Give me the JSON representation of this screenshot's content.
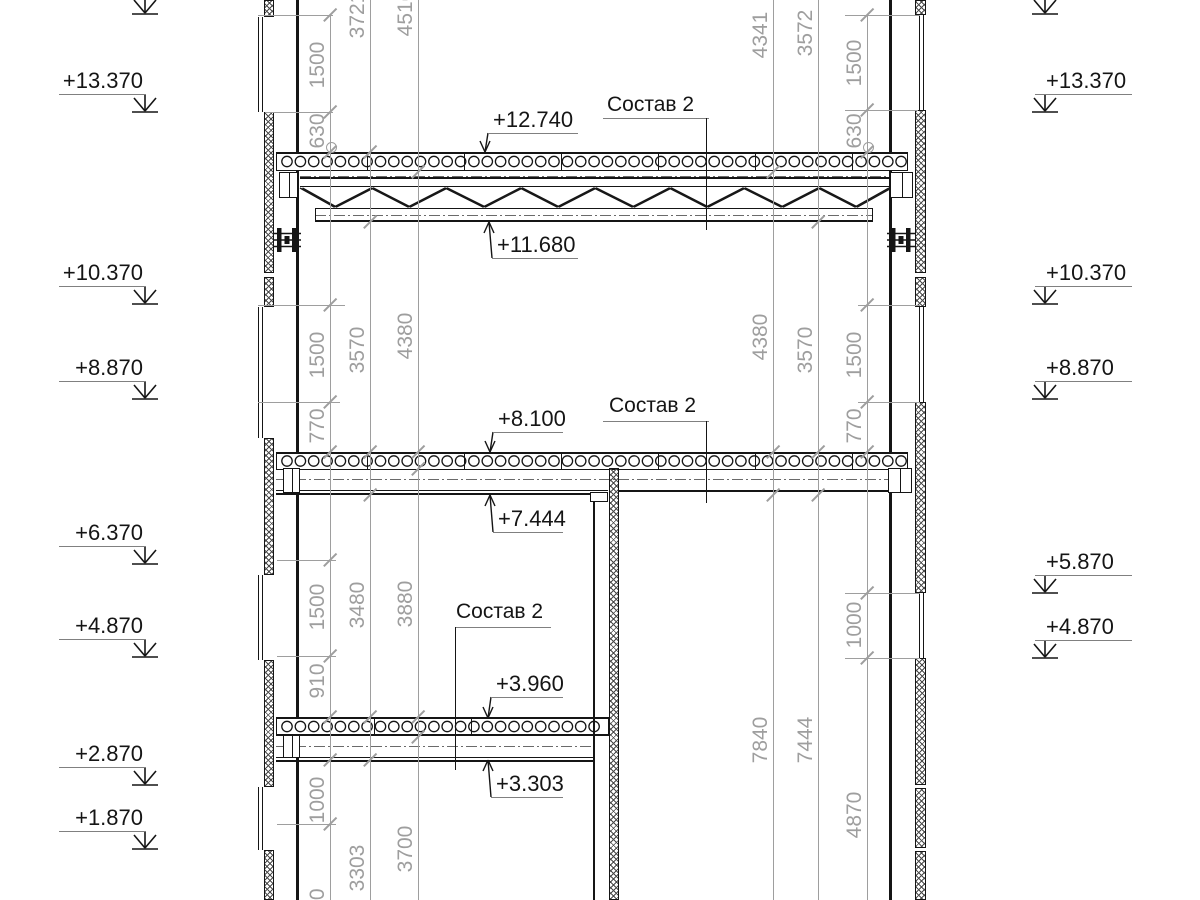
{
  "drawing": {
    "colors": {
      "line": "#151515",
      "dim": "#9e9e9e",
      "underline": "#808080",
      "background": "#ffffff"
    },
    "elevation_marks": {
      "left": [
        {
          "label": null,
          "uy": -4
        },
        {
          "label": "+13.370",
          "uy": 94
        },
        {
          "label": "+10.370",
          "uy": 286
        },
        {
          "label": "+8.870",
          "uy": 381
        },
        {
          "label": "+6.370",
          "uy": 546
        },
        {
          "label": "+4.870",
          "uy": 639
        },
        {
          "label": "+2.870",
          "uy": 767
        },
        {
          "label": "+1.870",
          "uy": 831
        }
      ],
      "right": [
        {
          "label": null,
          "uy": -4
        },
        {
          "label": "+13.370",
          "uy": 94
        },
        {
          "label": "+10.370",
          "uy": 286
        },
        {
          "label": "+8.870",
          "uy": 381
        },
        {
          "label": "+5.870",
          "uy": 575
        },
        {
          "label": "+4.870",
          "uy": 640
        }
      ]
    },
    "spot_elevations": [
      {
        "label": "+12.740",
        "x": 488,
        "uy": 133,
        "w": 90,
        "tip": 152,
        "dir": "down"
      },
      {
        "label": "+11.680",
        "x": 492,
        "uy": 258,
        "w": 86,
        "tip": 222,
        "dir": "up"
      },
      {
        "label": "+8.100",
        "x": 493,
        "uy": 432,
        "w": 70,
        "tip": 452,
        "dir": "down"
      },
      {
        "label": "+7.444",
        "x": 493,
        "uy": 532,
        "w": 70,
        "tip": 495,
        "dir": "up"
      },
      {
        "label": "+3.960",
        "x": 491,
        "uy": 697,
        "w": 72,
        "tip": 718,
        "dir": "down"
      },
      {
        "label": "+3.303",
        "x": 491,
        "uy": 797,
        "w": 72,
        "tip": 760,
        "dir": "up"
      }
    ],
    "composition_labels": [
      {
        "text": "Состав 2",
        "tx": 607,
        "ty": 94,
        "ux1": 603,
        "ux2": 709,
        "uy": 118,
        "lx": 706,
        "ly1": 118,
        "ly2": 230
      },
      {
        "text": "Состав 2",
        "tx": 609,
        "ty": 395,
        "ux1": 603,
        "ux2": 709,
        "uy": 421,
        "lx": 706,
        "ly1": 421,
        "ly2": 503
      },
      {
        "text": "Состав 2",
        "tx": 456,
        "ty": 601,
        "ux1": 455,
        "ux2": 551,
        "uy": 627,
        "lx": 455,
        "ly1": 627,
        "ly2": 770
      }
    ],
    "dimension_chains": {
      "left": [
        {
          "x": 330,
          "y1": 15,
          "y2": 900,
          "items": [
            {
              "t": "1500",
              "cy": 65
            },
            {
              "t": "630",
              "cy": 131
            },
            {
              "t": "1500",
              "cy": 355
            },
            {
              "t": "770",
              "cy": 426
            },
            {
              "t": "1500",
              "cy": 607
            },
            {
              "t": "910",
              "cy": 681
            },
            {
              "t": "1000",
              "cy": 800
            },
            {
              "t": "970",
              "cy": 906
            }
          ]
        },
        {
          "x": 370,
          "y1": 0,
          "y2": 900,
          "items": [
            {
              "t": "3721",
              "cy": 15
            },
            {
              "t": "3570",
              "cy": 350
            },
            {
              "t": "3480",
              "cy": 605
            },
            {
              "t": "3303",
              "cy": 868
            }
          ]
        },
        {
          "x": 418,
          "y1": 0,
          "y2": 900,
          "items": [
            {
              "t": "4516",
              "cy": 13
            },
            {
              "t": "4380",
              "cy": 336
            },
            {
              "t": "3880",
              "cy": 604
            },
            {
              "t": "3700",
              "cy": 849
            }
          ]
        }
      ],
      "right": [
        {
          "x": 867,
          "y1": 15,
          "y2": 900,
          "items": [
            {
              "t": "1500",
              "cy": 63
            },
            {
              "t": "630",
              "cy": 131
            },
            {
              "t": "1500",
              "cy": 355
            },
            {
              "t": "770",
              "cy": 426
            },
            {
              "t": "1000",
              "cy": 625
            },
            {
              "t": "4870",
              "cy": 815
            }
          ]
        },
        {
          "x": 818,
          "y1": 0,
          "y2": 900,
          "items": [
            {
              "t": "3572",
              "cy": 33
            },
            {
              "t": "3570",
              "cy": 350
            },
            {
              "t": "7444",
              "cy": 740
            }
          ]
        },
        {
          "x": 773,
          "y1": 0,
          "y2": 900,
          "items": [
            {
              "t": "4341",
              "cy": 35
            },
            {
              "t": "4380",
              "cy": 337
            },
            {
              "t": "7840",
              "cy": 740
            }
          ]
        }
      ]
    },
    "extension_lines": [
      [
        258,
        333,
        15
      ],
      [
        265,
        333,
        112
      ],
      [
        258,
        345,
        305
      ],
      [
        258,
        340,
        402
      ],
      [
        277,
        336,
        560
      ],
      [
        277,
        336,
        656
      ],
      [
        277,
        336,
        824
      ],
      [
        845,
        920,
        15
      ],
      [
        845,
        918,
        110
      ],
      [
        858,
        920,
        305
      ],
      [
        858,
        920,
        402
      ],
      [
        845,
        920,
        593
      ],
      [
        845,
        920,
        658
      ]
    ],
    "ticks": [
      [
        330,
        15
      ],
      [
        330,
        112
      ],
      [
        330,
        152
      ],
      [
        330,
        305
      ],
      [
        330,
        402
      ],
      [
        330,
        452
      ],
      [
        330,
        560
      ],
      [
        330,
        656
      ],
      [
        330,
        717
      ],
      [
        330,
        760
      ],
      [
        330,
        824
      ],
      [
        370,
        152
      ],
      [
        370,
        222
      ],
      [
        370,
        452
      ],
      [
        370,
        495
      ],
      [
        370,
        717
      ],
      [
        370,
        760
      ],
      [
        418,
        172
      ],
      [
        418,
        452
      ],
      [
        418,
        469
      ],
      [
        418,
        717
      ],
      [
        418,
        737
      ],
      [
        867,
        15
      ],
      [
        867,
        110
      ],
      [
        867,
        152
      ],
      [
        867,
        305
      ],
      [
        867,
        402
      ],
      [
        867,
        452
      ],
      [
        867,
        593
      ],
      [
        867,
        658
      ],
      [
        818,
        222
      ],
      [
        818,
        452
      ],
      [
        818,
        495
      ],
      [
        773,
        172
      ],
      [
        773,
        452
      ],
      [
        773,
        495
      ]
    ],
    "dim_circles": [
      [
        330,
        146
      ],
      [
        867,
        146
      ]
    ],
    "slabs": [
      {
        "x1": 276,
        "x2": 908,
        "top": 152,
        "cy": 161.5,
        "cx1": 282,
        "cx2": 904,
        "bottom": 169.5,
        "joints": [
          367,
          464,
          561,
          658,
          755,
          852
        ],
        "soffits": [],
        "dashdot": null
      },
      {
        "x1": 276,
        "x2": 908,
        "top": 451.5,
        "cy": 461,
        "cx1": 282,
        "cx2": 904,
        "bottom": 468.5,
        "joints": [
          367,
          464,
          561,
          658,
          755,
          852
        ],
        "soffits": [
          [
            276,
            608,
            489.5,
            1
          ],
          [
            276,
            608,
            493,
            2
          ],
          [
            618,
            890,
            490,
            2
          ]
        ],
        "dashdot": [
          276,
          890,
          479
        ]
      },
      {
        "x1": 276,
        "x2": 609,
        "top": 717,
        "cy": 726.5,
        "cx1": 282,
        "cx2": 603,
        "bottom": 734,
        "joints": [
          374,
          471
        ],
        "soffits": [
          [
            276,
            593,
            757,
            1
          ],
          [
            276,
            593,
            759.5,
            2
          ]
        ],
        "dashdot": [
          276,
          593,
          746
        ]
      }
    ],
    "centerlines": [
      [
        300,
        888,
        175.5
      ],
      [
        315,
        873,
        214.5
      ]
    ],
    "truss": {
      "x1": 300,
      "x2": 889,
      "top_y": 177,
      "top_y2": 185.5,
      "bot_x1": 315,
      "bot_x2": 873,
      "bot_y": 208,
      "bot_y2": 219.5,
      "node_y_top": 188,
      "node_y_bot": 207,
      "top_nodes": [
        300,
        371,
        445,
        520,
        594,
        669,
        743,
        818,
        889
      ],
      "bot_nodes": [
        334,
        408,
        483,
        557,
        632,
        706,
        781,
        855
      ]
    },
    "walls": [
      {
        "name": "left-wall",
        "hatch_x": 263.5,
        "hatch_w": 10.5,
        "segments": [
          [
            0,
            17
          ],
          [
            112,
            273
          ],
          [
            277,
            307
          ],
          [
            438,
            575
          ],
          [
            660,
            787
          ],
          [
            850,
            900
          ]
        ],
        "windows": [
          [
            17,
            112
          ],
          [
            307,
            438
          ],
          [
            575,
            660
          ],
          [
            787,
            850
          ]
        ],
        "window_x": 257.5,
        "face_x": 296,
        "face_w": 2.5,
        "face_segments": [
          [
            0,
            152
          ],
          [
            170,
            452
          ],
          [
            470,
            717
          ],
          [
            734,
            900
          ]
        ]
      },
      {
        "name": "right-wall",
        "hatch_x": 915,
        "hatch_w": 10.5,
        "segments": [
          [
            0,
            15
          ],
          [
            110,
            273
          ],
          [
            277,
            307
          ],
          [
            402,
            593
          ],
          [
            658,
            785
          ],
          [
            788,
            848
          ],
          [
            851,
            900
          ]
        ],
        "windows": [
          [
            15,
            110
          ],
          [
            307,
            402
          ],
          [
            593,
            658
          ]
        ],
        "window_x": 918.5,
        "face_x": 889,
        "face_w": 2.5,
        "face_segments": [
          [
            0,
            152
          ],
          [
            170,
            452
          ],
          [
            470,
            900
          ]
        ]
      },
      {
        "name": "interior-wall",
        "hatch_x": 608.5,
        "hatch_w": 10,
        "segments": [
          [
            468,
            900
          ]
        ],
        "windows": [],
        "window_x": null,
        "face_x": 593,
        "face_w": 2,
        "face_segments": [
          [
            497,
            900
          ]
        ]
      }
    ],
    "bearing_boxes": [
      [
        279,
        172,
        19,
        26
      ],
      [
        890,
        172,
        23,
        26
      ],
      [
        283,
        468,
        17,
        25
      ],
      [
        888,
        468,
        24,
        25
      ],
      [
        283,
        735,
        17,
        23
      ]
    ],
    "corbel": [
      590,
      492,
      18,
      10
    ],
    "anchor_brackets": [
      [
        275,
        228
      ],
      [
        889,
        228
      ]
    ]
  }
}
